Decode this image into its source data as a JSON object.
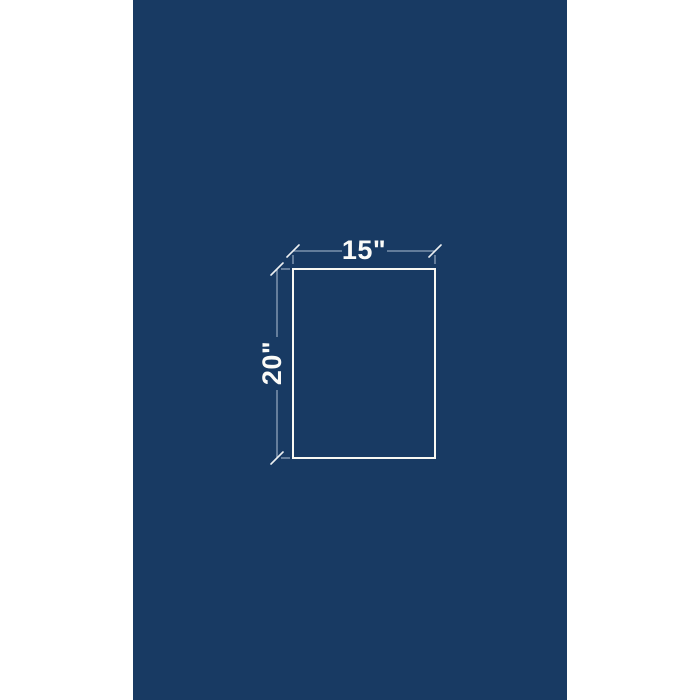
{
  "page": {
    "background": "#FFFFFF"
  },
  "panel": {
    "background": "#183A63"
  },
  "diagram": {
    "shape": "rectangle-outline",
    "width_label": "15\"",
    "height_label": "20\"",
    "width_value": 15,
    "height_value": 20,
    "unit": "inches"
  },
  "colors": {
    "page_background": "#FFFFFF",
    "panel_background": "#183A63",
    "outline": "#F8F8F3",
    "dimension_line": "#8FA3BB",
    "tick": "#EDF0F2",
    "label_text": "#FBFBF8"
  }
}
